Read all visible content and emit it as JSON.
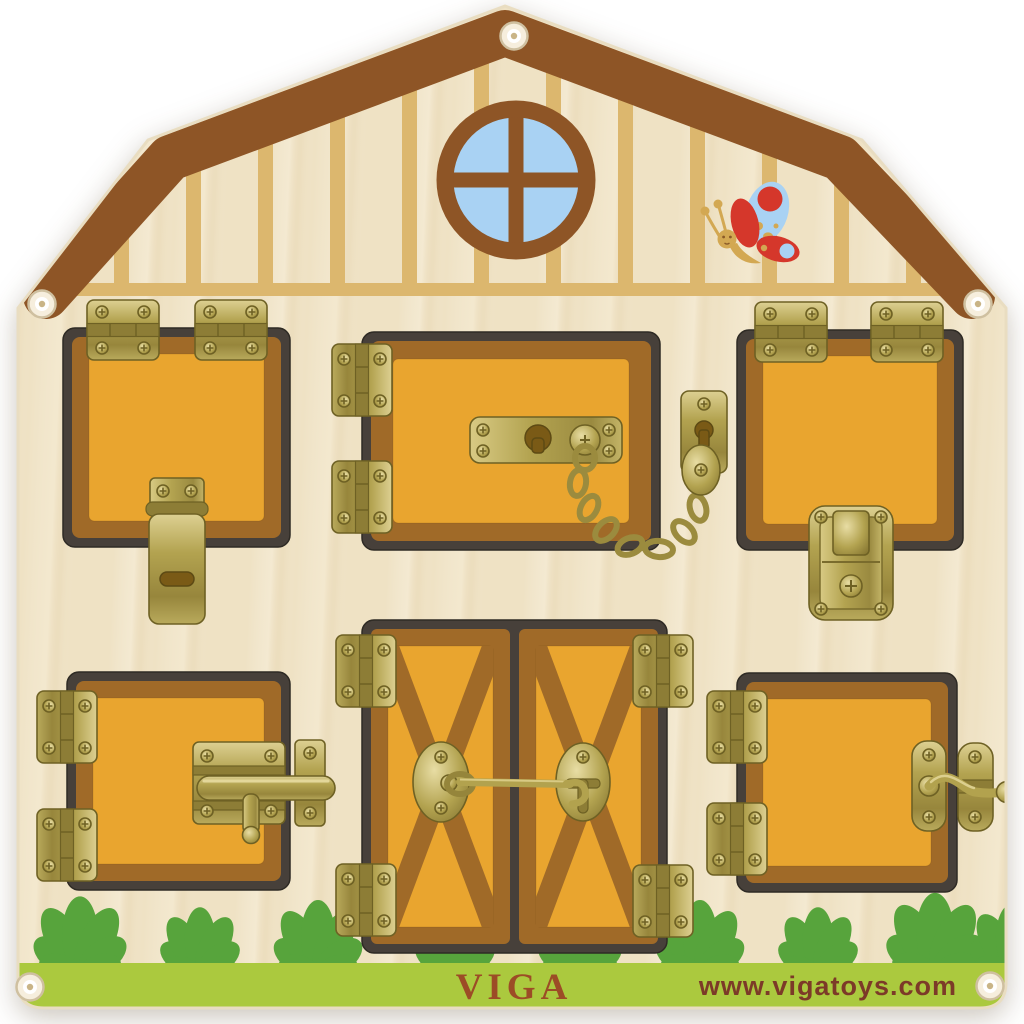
{
  "brand": {
    "name": "VIGA",
    "website": "www.vigatoys.com"
  },
  "colors": {
    "background": "#ffffff",
    "board_wood": "#efe2c4",
    "board_wood_light": "#f8efdb",
    "stripe_tan": "#dcb76e",
    "roof_brown": "#8e5526",
    "window_blue": "#a9d2f3",
    "door_orange": "#e9a52f",
    "door_brown": "#a06a28",
    "frame_dark": "#47403a",
    "brass": "#b2a24e",
    "brass_dark": "#857434",
    "brass_light": "#dccf8e",
    "grass_green": "#57a43c",
    "band_green": "#abc93e",
    "logo_red": "#9c4c26",
    "website_red": "#7c3a28",
    "butterfly_red": "#d5372b",
    "butterfly_tan": "#d3a852"
  },
  "icons": {
    "window": "round-barn-window",
    "butterfly": "butterfly",
    "hinges": "brass-butt-hinge",
    "latch_top_left": "hasp-latch",
    "latch_top_middle": "door-chain-guard",
    "latch_top_right": "case-clasp",
    "latch_bottom_left": "barrel-bolt",
    "latch_center": "cabin-hook",
    "latch_bottom_right": "swivel-gate-latch",
    "corners": "eyelet-screw",
    "ground": "grass-bushes"
  }
}
